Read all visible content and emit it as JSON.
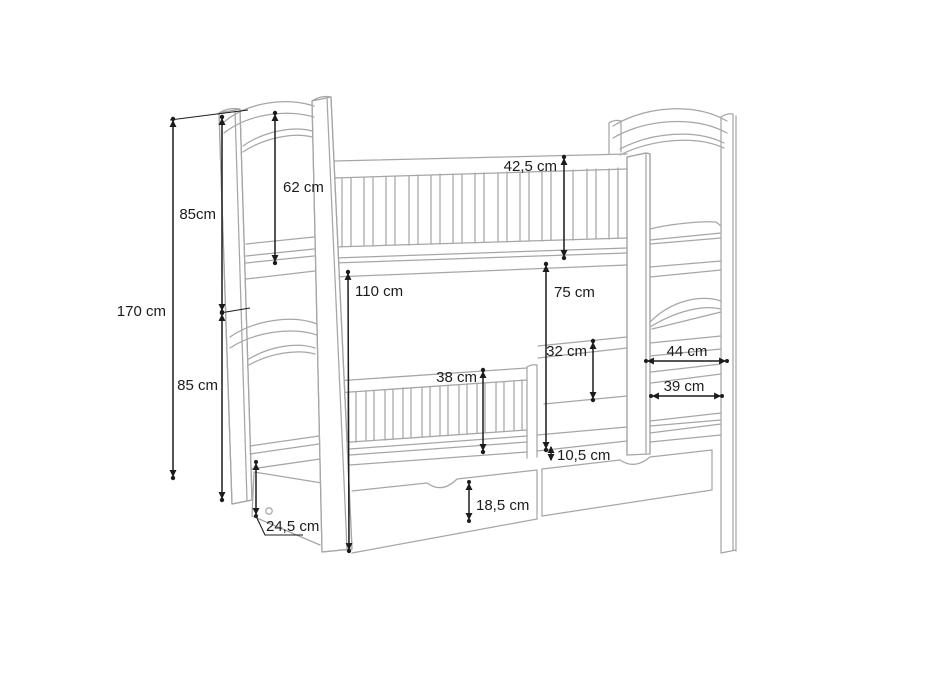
{
  "drawing": {
    "kind": "technical dimension drawing",
    "subject": "bunk bed with guard rails, ladder and two under-bed storage drawers",
    "unit": "cm",
    "line_color": "#a6a6a6",
    "dimension_color": "#1c1c1c",
    "background": "#ffffff"
  },
  "dims": {
    "total_height": "170 cm",
    "upper_section_height": "85cm",
    "upper_headboard_panel": "62 cm",
    "lower_section_height": "85 cm",
    "clearance_under_top_bunk": "110 cm",
    "top_guard_rail_height": "42,5 cm",
    "space_above_lower_bunk": "75 cm",
    "ladder_rail_gap": "32 cm",
    "lower_guard_rail_height": "38 cm",
    "ladder_width_top": "44 cm",
    "ladder_width_bottom": "39 cm",
    "rail_to_drawer_gap": "10,5 cm",
    "drawer_front_height": "18,5 cm",
    "drawer_side_depth": "24,5 cm"
  }
}
